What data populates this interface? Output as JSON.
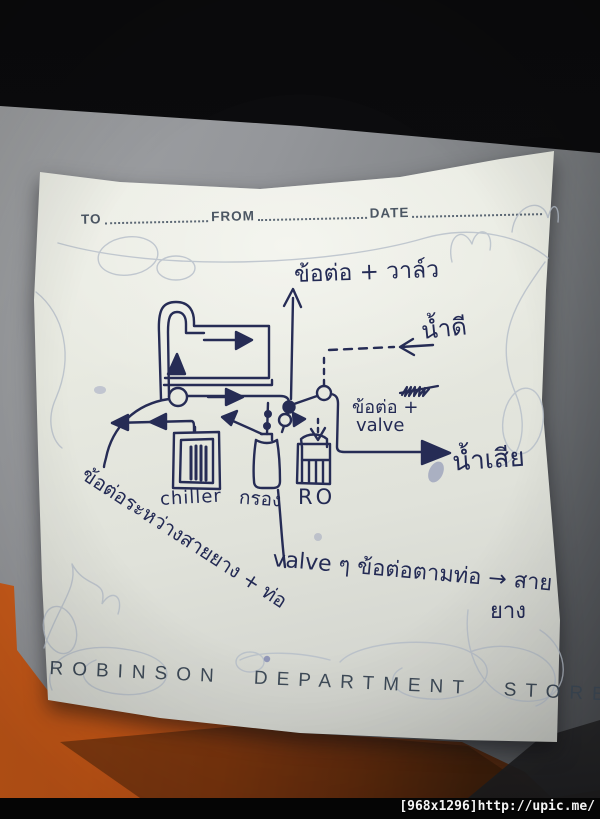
{
  "photo": {
    "watermark": "[968x1296]http://upic.me/"
  },
  "note": {
    "brand_footer": "ROBINSON DEPARTMENT STORE",
    "header": {
      "to_label": "TO",
      "from_label": "FROM",
      "date_label": "DATE"
    },
    "colors": {
      "ink": "#252b54",
      "printed_text": "#46525f",
      "decorative_swirl": "#b5bdc9",
      "paper": "#e8eae1",
      "background_orange": "#ca5917",
      "background_dark": "#0b0b0d"
    },
    "diagram": {
      "labels": {
        "top_connector_valve": "ข้อต่อ + วาล์ว",
        "clean_water": "น้ำดี",
        "waste_water": "น้ำเสีย",
        "connector_line1": "ข้อต่อ +",
        "connector_line2": "valve",
        "chiller_unit": "chiller",
        "filter_unit": "กรอง",
        "ro_unit": "RO",
        "hose_pipe_connector_note": "ข้อต่อระหว่างสายยาง + ท่อ",
        "valve_connector_note_line1": "valve ๆ ข้อต่อตามท่อ → สาย",
        "valve_connector_note_line2": "ยาง"
      }
    }
  }
}
